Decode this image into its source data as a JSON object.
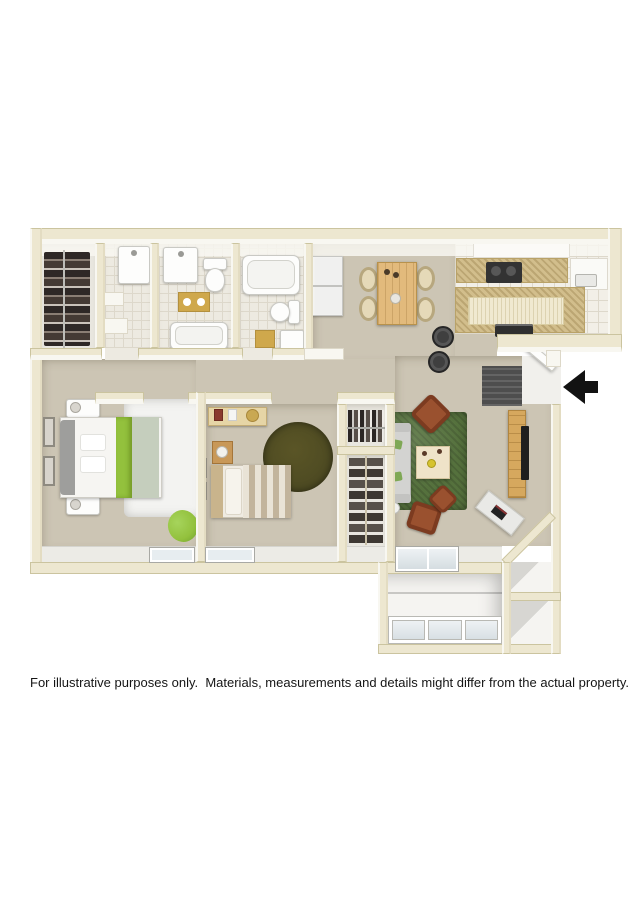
{
  "disclaimer": "For illustrative purposes only.  Materials, measurements and details might differ from the actual property.",
  "icons": {
    "entry_arrow": "left-arrow"
  },
  "palette": {
    "page-bg": "#ffffff",
    "wall": "#ede7d0",
    "wall-edge": "#cbc49f",
    "wall-face": "#f8f7f1",
    "carpet": "#ccc5b4",
    "tile": "#edeae1",
    "tile-line": "#ddd8cb",
    "kitchen-tile": "#f2efe7",
    "closet-floor": "#e9e7e0",
    "patio-floor": "#f5f4f1",
    "counter": "#d2be8c",
    "island-top": "#f0e9d0",
    "wood": "#e2ba7c",
    "wood-dark": "#d6a85e",
    "fridge": "#f0f0ef",
    "appliance": "#333333",
    "rug-green": "#55713d",
    "rug-olive": "#4d4a22",
    "rug-white": "#f3f3f1",
    "chair-rust": "#9a512f",
    "chair-rust-dark": "#7c3b20",
    "accent-green": "#93c13d",
    "sage": "#c5cebd",
    "sofa": "#d3d3d1",
    "sofa-back": "#b9b9b7",
    "headboard": "#9e9e9c",
    "gold": "#cfa84c",
    "doormat": "#4e4e4e",
    "arrow": "#121212",
    "glass": "#e7edf0",
    "text": "#151515"
  }
}
